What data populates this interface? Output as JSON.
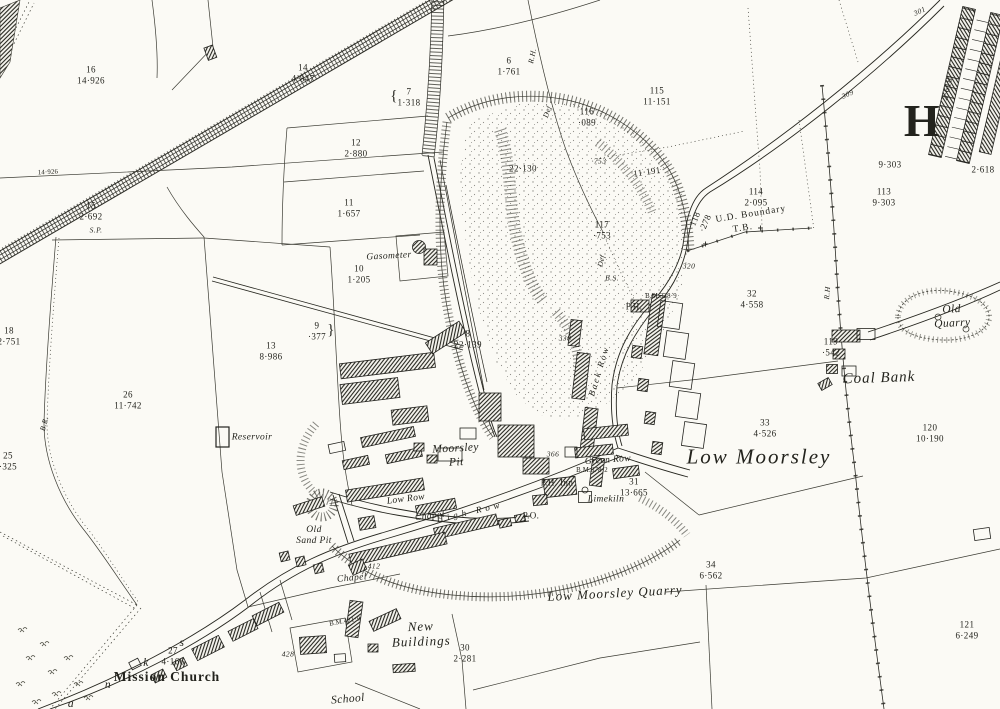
{
  "colors": {
    "paper": "#fbfaf5",
    "ink": "#26261f",
    "hachure": "#3c3c34"
  },
  "labels": {
    "plot16": "16\n14·926",
    "plot14": "14\n4·847",
    "plot7": "7\n1·318",
    "brace7": "{",
    "plot6": "6\n1·761",
    "plot115": "115\n11·151",
    "plot116": "116\n·089",
    "spot753": "·753",
    "plot117": "117\n·753",
    "acre11191": "11·191",
    "plot12": "12\n2·880",
    "plot11": "11\n1·657",
    "plot15": "15\n2·692",
    "sp": "S.P.",
    "plot18": "18\n2·751",
    "plot13": "13\n8·986",
    "plot9": "9\n·377",
    "brace9": "}",
    "plot8": "8\n22·139",
    "plot10": "10\n1·205",
    "gasometer": "Gasometer",
    "plot26": "26\n11·742",
    "reservoir": "Reservoir",
    "plot25": "25\n·325",
    "br": "B.R.",
    "moorsley_pit": "Moorsley\nPit",
    "acre22130": "22·130",
    "rh_top": "R.H.",
    "def_top": "Def",
    "def_mid": "Def",
    "bs": "B.S.",
    "bm328": "B.M.328·9",
    "ph": "P.H.",
    "plot32": "32\n4·558",
    "spot320": "320",
    "road118": "118\n·278",
    "ud_boundary": "U.D. Boundary",
    "tb": "T.B.",
    "spot309": "309",
    "spot301": "301",
    "big_h": "H",
    "acre2618_row": "2·618",
    "acre2618": "2·618",
    "acre9303": "9·303",
    "plot113": "113\n9·303",
    "plot114": "114\n2·095",
    "old_quarry": "Old Quarry",
    "rh_right": "R.H",
    "coal_bank": "Coal Bank",
    "plot119": "119\n·542",
    "plot33": "33\n4·526",
    "low_moorsley": "Low Moorsley",
    "plot120": "120\n10·190",
    "back_row": "Back Row",
    "green_row": "Green Row",
    "bm378": "B.M.378·2",
    "spot366": "366",
    "spot338": "338",
    "plot31": "31\n13·665",
    "ph_inn": "P.H. Inn",
    "limekiln": "Limekiln",
    "po": "P.O.",
    "low_row": "Low Row",
    "chapel1": "Chapel",
    "high_row": "High Row",
    "chapel2": "Chapel",
    "spot412": "412",
    "old_sand_pit": "Old\nSand Pit",
    "low_moorsley_quarry": "Low Moorsley Quarry",
    "plot34": "34\n6·562",
    "plot30": "30\n2·281",
    "new_buildings": "New\nBuildings",
    "bm421": "B.M.421·9",
    "spot428": "428",
    "plot27": "27\n4·166",
    "letter_k": "k",
    "letter_s": "s",
    "letter_n": "n",
    "letter_a": "a",
    "mission_church": "Mission Church",
    "school": "School",
    "plot121": "121\n6·249",
    "acre14926_line": "14·926"
  }
}
